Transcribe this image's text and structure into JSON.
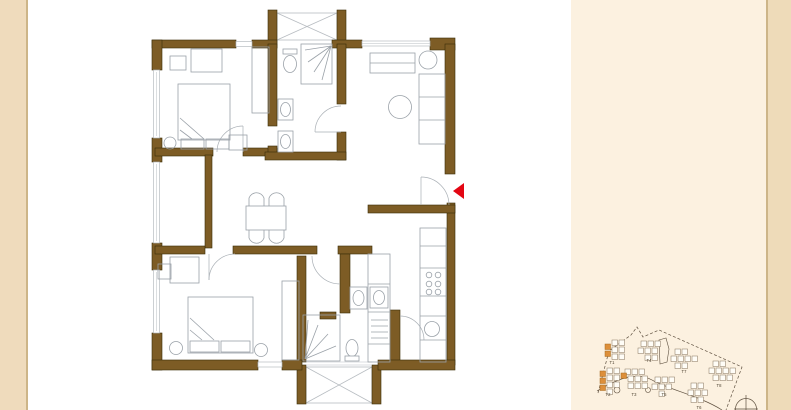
{
  "palette": {
    "wall_brown": "#7d5c25",
    "wall_edge": "#3a2c07",
    "line_gray": "#b7bcc1",
    "fixture_gray": "#9aa1a8",
    "accent_red": "#e30613",
    "left_strip_bg": "#efdbbc",
    "right_panel_bg": "#fcf1e0",
    "right_strip_bg": "#eedbb9",
    "strip_border": "#cdb588",
    "siteplan_line": "#5f5140",
    "unit_highlight": "#dd8f3a"
  },
  "siteplan": {
    "unit_size": 5.5,
    "clusters": [
      {
        "label": "T1",
        "label_pos": [
          612,
          364
        ],
        "units": [
          [
            612,
            340,
            0
          ],
          [
            619,
            340,
            0
          ],
          [
            605,
            344,
            1
          ],
          [
            612,
            347,
            0
          ],
          [
            619,
            347,
            0
          ],
          [
            605,
            351,
            1
          ],
          [
            612,
            354,
            0
          ],
          [
            619,
            354,
            0
          ]
        ]
      },
      {
        "label": "T2",
        "label_pos": [
          608,
          396
        ],
        "units": [
          [
            607,
            368,
            0
          ],
          [
            614,
            368,
            0
          ],
          [
            600,
            371,
            1
          ],
          [
            607,
            375,
            0
          ],
          [
            614,
            375,
            0
          ],
          [
            600,
            378,
            1
          ],
          [
            607,
            382,
            0
          ],
          [
            614,
            382,
            0
          ],
          [
            600,
            385,
            1
          ],
          [
            607,
            389,
            0
          ]
        ]
      },
      {
        "label": "T3",
        "label_pos": [
          634,
          396
        ],
        "units": [
          [
            625,
            369,
            0
          ],
          [
            632,
            369,
            0
          ],
          [
            639,
            369,
            0
          ],
          [
            621,
            373,
            1
          ],
          [
            628,
            376,
            0
          ],
          [
            635,
            376,
            0
          ],
          [
            642,
            376,
            0
          ],
          [
            628,
            383,
            0
          ],
          [
            635,
            383,
            0
          ],
          [
            642,
            383,
            0
          ]
        ]
      },
      {
        "label": "T4",
        "label_pos": [
          649,
          362
        ],
        "units": [
          [
            641,
            341,
            0
          ],
          [
            648,
            341,
            0
          ],
          [
            655,
            341,
            0
          ],
          [
            638,
            348,
            0
          ],
          [
            645,
            348,
            0
          ],
          [
            652,
            348,
            0
          ],
          [
            645,
            355,
            0
          ],
          [
            652,
            355,
            0
          ]
        ]
      },
      {
        "label": "T7",
        "label_pos": [
          684,
          373
        ],
        "units": [
          [
            675,
            349,
            0
          ],
          [
            682,
            349,
            0
          ],
          [
            671,
            356,
            0
          ],
          [
            678,
            356,
            0
          ],
          [
            685,
            356,
            0
          ],
          [
            692,
            356,
            0
          ],
          [
            675,
            363,
            0
          ],
          [
            682,
            363,
            0
          ]
        ]
      },
      {
        "label": "T5",
        "label_pos": [
          664,
          396
        ],
        "units": [
          [
            655,
            377,
            0
          ],
          [
            662,
            377,
            0
          ],
          [
            669,
            377,
            0
          ],
          [
            652,
            384,
            0
          ],
          [
            659,
            384,
            0
          ],
          [
            666,
            384,
            0
          ],
          [
            659,
            391,
            0
          ]
        ]
      },
      {
        "label": "T6",
        "label_pos": [
          699,
          409
        ],
        "units": [
          [
            691,
            383,
            0
          ],
          [
            698,
            383,
            0
          ],
          [
            688,
            390,
            0
          ],
          [
            695,
            390,
            0
          ],
          [
            702,
            390,
            0
          ],
          [
            691,
            397,
            0
          ],
          [
            698,
            397,
            0
          ]
        ]
      },
      {
        "label": "T8",
        "label_pos": [
          719,
          387
        ],
        "units": [
          [
            713,
            361,
            0
          ],
          [
            720,
            361,
            0
          ],
          [
            709,
            368,
            0
          ],
          [
            716,
            368,
            0
          ],
          [
            723,
            368,
            0
          ],
          [
            730,
            368,
            0
          ],
          [
            713,
            375,
            0
          ],
          [
            720,
            375,
            0
          ],
          [
            727,
            375,
            0
          ]
        ]
      }
    ]
  }
}
